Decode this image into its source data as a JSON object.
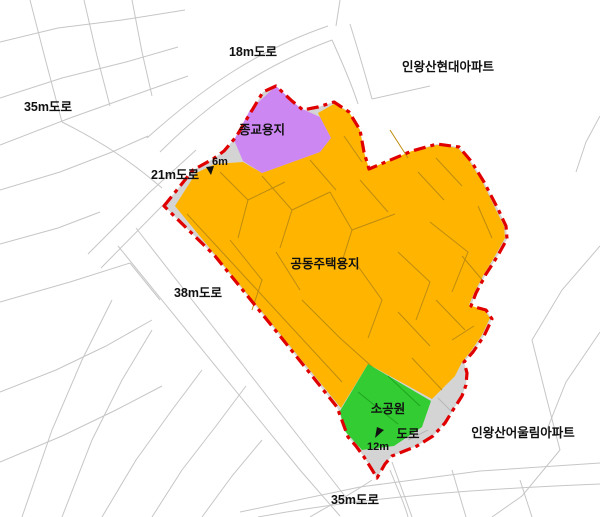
{
  "colors": {
    "background": "#FFFFFF",
    "housing": "#FFB400",
    "religious": "#CD87F2",
    "park": "#33CC33",
    "road_band": "#D4D4D4",
    "boundary": "#E00000",
    "cadastral": "#C6C6C6",
    "parcel_orange": "#BE8C10",
    "parcel_green": "#1FA51F",
    "parcel_gray": "#B8B8B8",
    "label": "#111111"
  },
  "labels": {
    "road_18m": "18m도로",
    "apartment_top_right": "인왕산현대아파트",
    "road_35m_left": "35m도로",
    "road_21m": "21m도로",
    "road_6m": "6m",
    "road_38m": "38m도로",
    "housing_site": "공동주택용지",
    "religious_site": "종교용지",
    "small_park": "소공원",
    "road": "도로",
    "road_12m": "12m",
    "apartment_bottom_right": "인왕산어울림아파트",
    "road_35m_bottom": "35m도로"
  }
}
